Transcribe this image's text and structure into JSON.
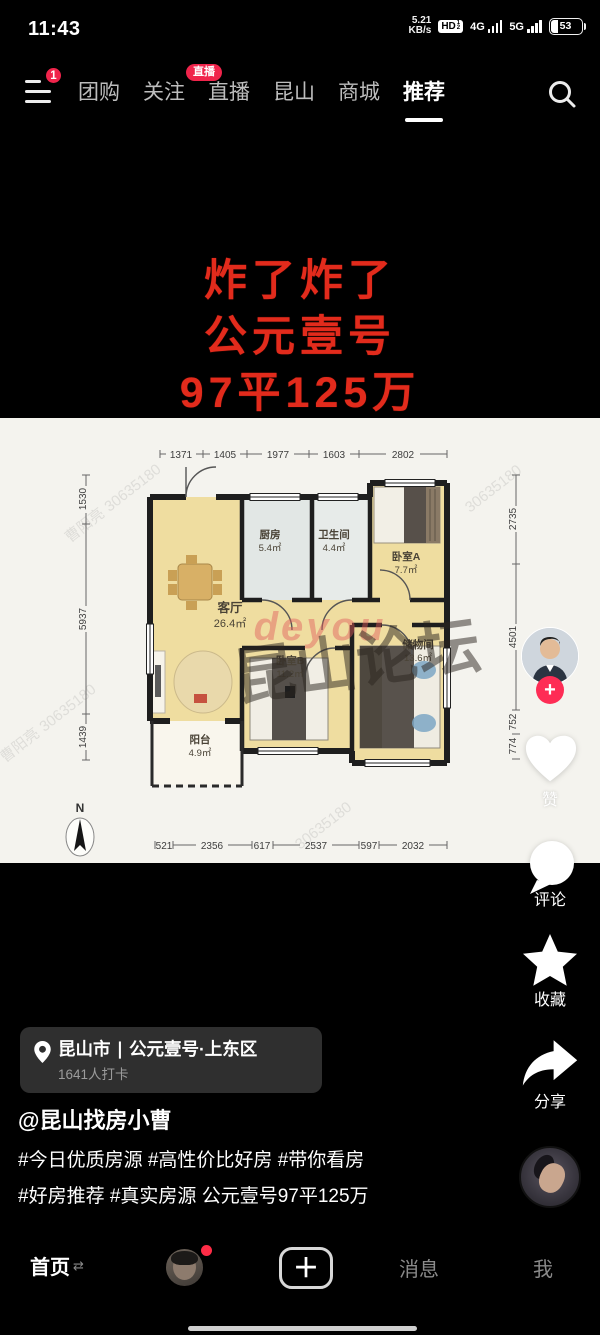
{
  "status_bar": {
    "time": "11:43",
    "net_speed_value": "5.21",
    "net_speed_unit": "KB/s",
    "hd_badge": "HD",
    "hd_sub_top": "1",
    "hd_sub_bottom": "2",
    "sim1": "4G",
    "sim2": "5G",
    "battery_level": "53"
  },
  "top_nav": {
    "menu_badge": "1",
    "live_badge": "直播",
    "tabs": [
      {
        "label": "团购"
      },
      {
        "label": "关注"
      },
      {
        "label": "直播"
      },
      {
        "label": "昆山"
      },
      {
        "label": "商城"
      },
      {
        "label": "推荐"
      }
    ]
  },
  "video_overlay": {
    "title_line1": "炸了炸了",
    "title_line2": "公元壹号",
    "title_line3": "97平125万",
    "title_color": "#e22b1c"
  },
  "floorplan": {
    "dims_top": [
      "1371",
      "1405",
      "1977",
      "1603",
      "2802"
    ],
    "dims_bottom": [
      "521",
      "2356",
      "617",
      "2537",
      "597",
      "2032"
    ],
    "dims_left": [
      "1530",
      "5937",
      "1439"
    ],
    "dims_right": [
      "2735",
      "4501",
      "752",
      "774"
    ],
    "rooms": [
      {
        "name": "厨房",
        "area": "5.4㎡"
      },
      {
        "name": "卫生间",
        "area": "4.4㎡"
      },
      {
        "name": "卧室A",
        "area": "7.7㎡"
      },
      {
        "name": "客厅",
        "area": "26.4㎡"
      },
      {
        "name": "卧室B",
        "area": "11.2㎡"
      },
      {
        "name": "储物间",
        "area": "13.6㎡"
      },
      {
        "name": "阳台",
        "area": "4.9㎡"
      }
    ],
    "compass_label": "N",
    "watermark_red": "deyou",
    "watermark_dark": "昆山论坛",
    "watermark_name": "曹阳亮",
    "watermark_id": "30635180"
  },
  "action_rail": {
    "like_label": "赞",
    "comment_label": "评论",
    "favorite_label": "收藏",
    "share_label": "分享"
  },
  "location_card": {
    "text": "昆山市 ∣ 公元壹号·上东区",
    "checkins": "1641人打卡"
  },
  "caption": {
    "username": "@昆山找房小曹",
    "line1": "#今日优质房源 #高性价比好房 #带你看房",
    "line2": "#好房推荐 #真实房源 公元壹号97平125万"
  },
  "bottom_nav": {
    "home": "首页",
    "messages": "消息",
    "me": "我"
  }
}
